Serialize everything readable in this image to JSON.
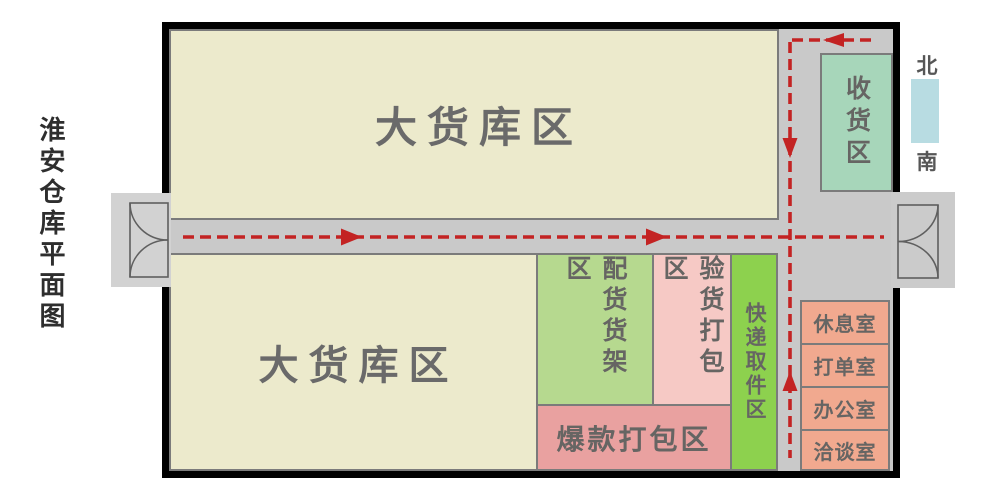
{
  "title": {
    "text": "淮安仓库平面图"
  },
  "compass": {
    "north": "北",
    "south": "南",
    "bar_color": "#b8dce2"
  },
  "zones": {
    "top_warehouse": {
      "label": "大货库区",
      "color": "#eceacc"
    },
    "bottom_warehouse": {
      "label": "大货库区",
      "color": "#eceacc"
    },
    "picking_shelf": {
      "label": "配货货架区",
      "color": "#b6d98f"
    },
    "inspection_pack": {
      "label": "验货打包区",
      "color": "#f6c9c5"
    },
    "express_pickup": {
      "label": "快递取件区",
      "color": "#8dd14e"
    },
    "hot_item_pack": {
      "label": "爆款打包区",
      "color": "#e9a1a0"
    },
    "receiving": {
      "label": "收货区",
      "color": "#a7d6ba"
    }
  },
  "rooms": [
    {
      "label": "休息室"
    },
    {
      "label": "打单室"
    },
    {
      "label": "办公室"
    },
    {
      "label": "洽谈室"
    }
  ],
  "style_notes": {
    "room_color": "#f1a98f",
    "corridor_color": "#c9c9c9",
    "wall_color": "#000000",
    "zone_border_color": "#7b7b7b",
    "flow_arrow_color": "#c32323",
    "label_text_color": "#666563"
  }
}
